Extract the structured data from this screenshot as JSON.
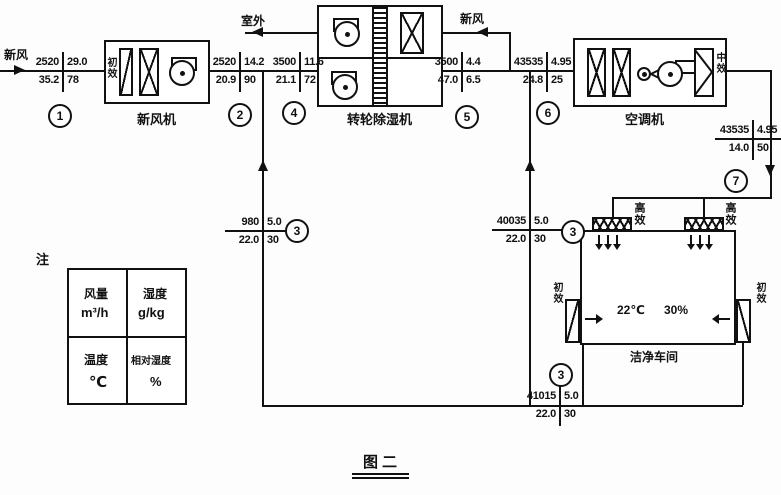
{
  "flows": {
    "fresh_air_in": "新风",
    "exhaust_outdoor": "室外",
    "regen_fresh_air": "新风"
  },
  "equipment": {
    "fresh_air_unit": "新风机",
    "rotary_dehumidifier": "转轮除湿机",
    "air_conditioner": "空调机",
    "clean_room": "洁净车间"
  },
  "filters": {
    "pre_filter": "初效",
    "medium_filter": "中效",
    "hepa_filter": "高效"
  },
  "room": {
    "temperature": "22℃",
    "relative_humidity": "30%"
  },
  "legend": {
    "note": "注",
    "airflow_label": "风量",
    "airflow_unit": "m³/h",
    "humidity_label": "湿度",
    "humidity_unit": "g/kg",
    "temperature_label": "温度",
    "temperature_unit": "℃",
    "rh_label": "相对湿度",
    "rh_unit": "%"
  },
  "figure": {
    "title": "图二"
  },
  "points": [
    {
      "circle": "1",
      "flow": "2520",
      "humidity": "29.0",
      "temp": "35.2",
      "rh": "78"
    },
    {
      "circle": "2",
      "flow": "2520",
      "humidity": "14.2",
      "temp": "20.9",
      "rh": "90"
    },
    {
      "circle": "4",
      "flow": "3500",
      "humidity": "11.6",
      "temp": "21.1",
      "rh": "72"
    },
    {
      "circle": "5",
      "flow": "3500",
      "humidity": "4.4",
      "temp": "47.0",
      "rh": "6.5"
    },
    {
      "circle": "6",
      "flow": "43535",
      "humidity": "4.95",
      "temp": "24.8",
      "rh": "25"
    },
    {
      "circle": "7",
      "flow": "43535",
      "humidity": "4.95",
      "temp": "14.0",
      "rh": "50"
    },
    {
      "circle": "3",
      "flow": "980",
      "humidity": "5.0",
      "temp": "22.0",
      "rh": "30"
    },
    {
      "circle": "3",
      "flow": "40035",
      "humidity": "5.0",
      "temp": "22.0",
      "rh": "30"
    },
    {
      "circle": "3",
      "flow": "41015",
      "humidity": "5.0",
      "temp": "22.0",
      "rh": "30"
    }
  ]
}
